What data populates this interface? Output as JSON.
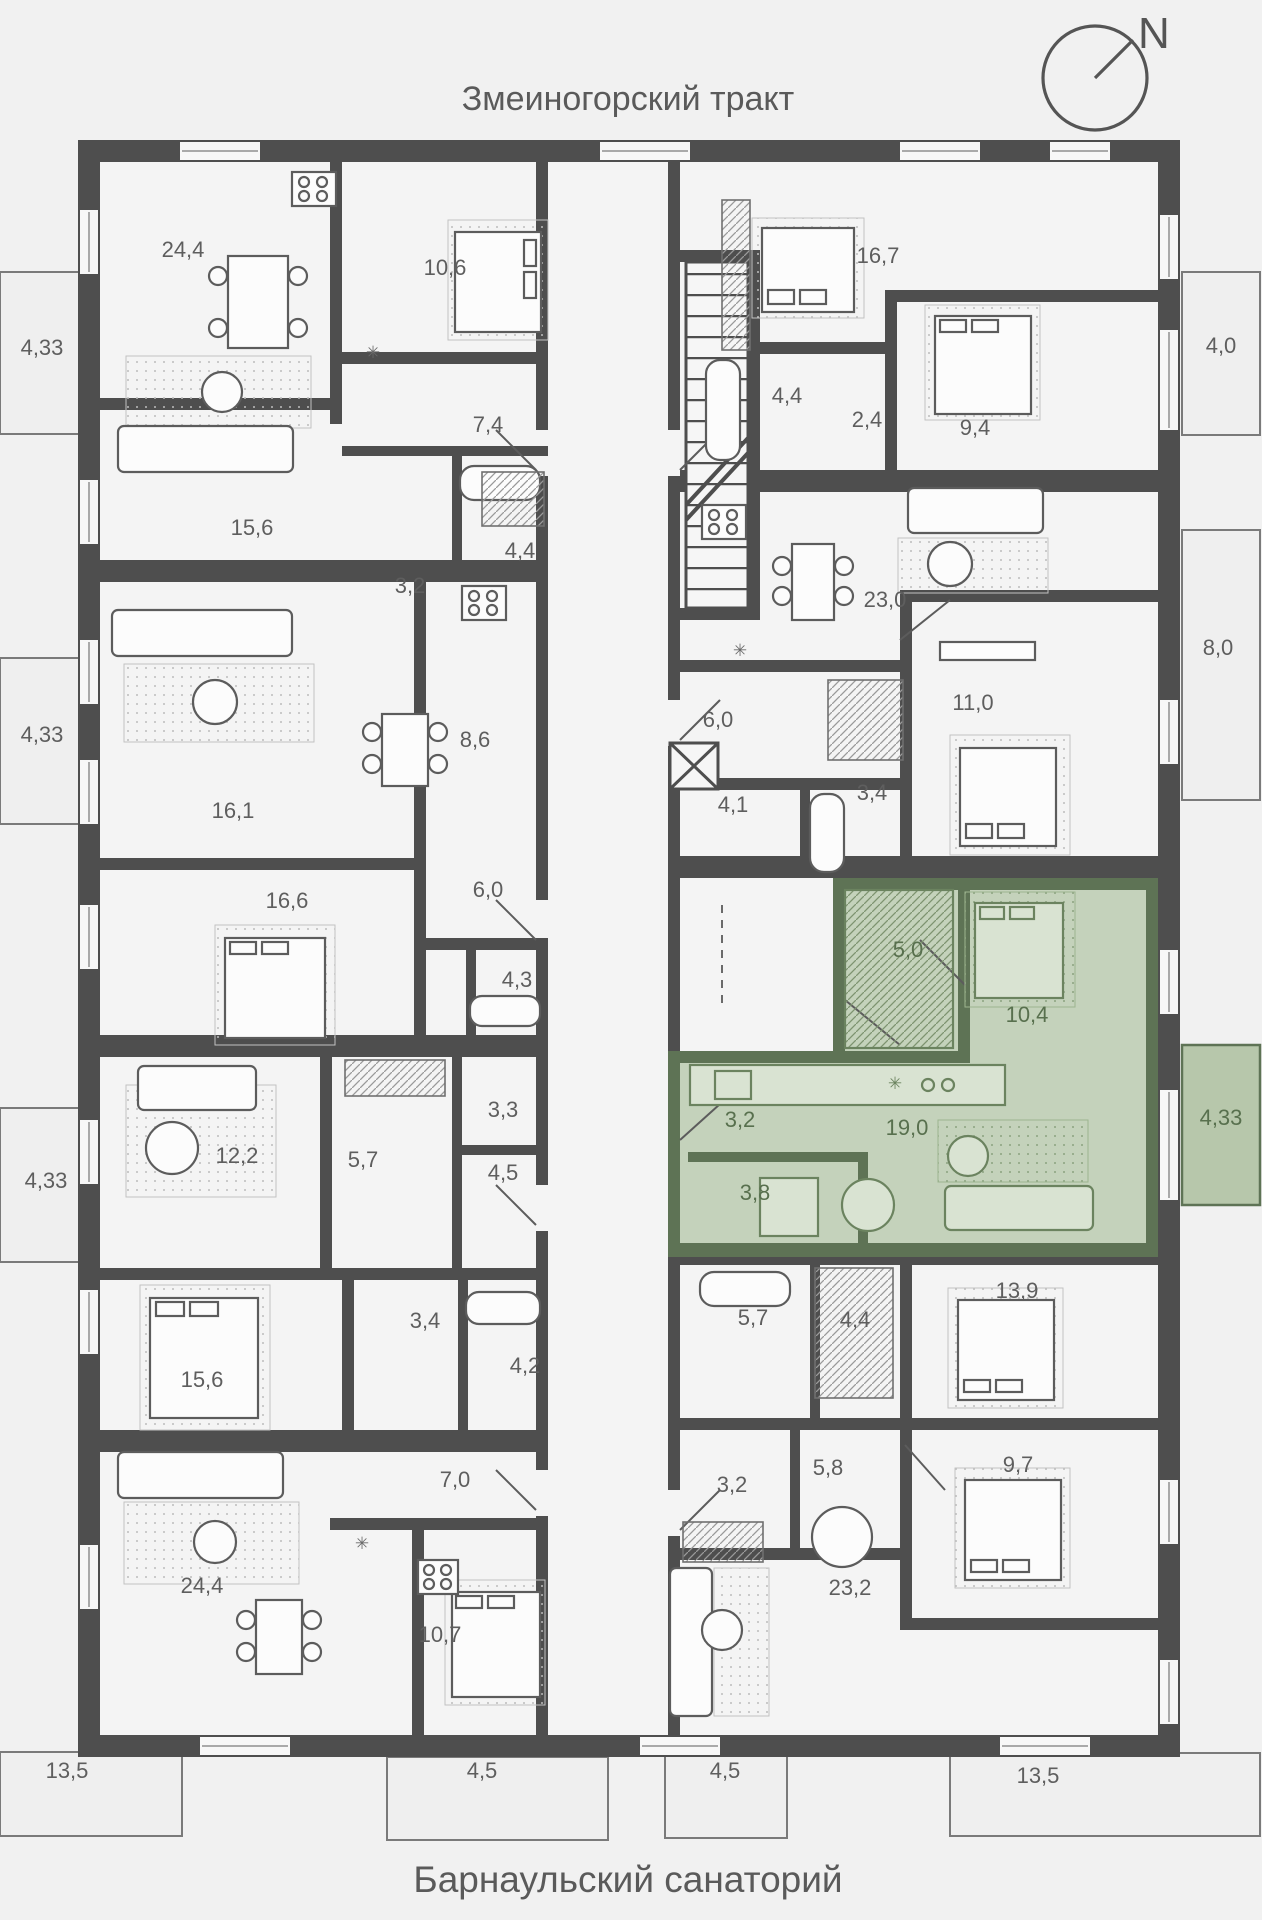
{
  "titles": {
    "top": "Змеиногорский тракт",
    "bottom": "Барнаульский санаторий"
  },
  "compass": {
    "label": "N"
  },
  "colors": {
    "background": "#f1f1f1",
    "room_fill": "#f4f4f4",
    "wall": "#4e4e4e",
    "furniture_stroke": "#5c5c5c",
    "balcony_fill": "#efefef",
    "highlight_room_fill": "#c4d2bb",
    "highlight_wall": "#5e7355",
    "highlight_furniture_stroke": "#6b835f",
    "highlight_balcony_fill": "#b7c7ab",
    "label_text": "#5e5e5e",
    "highlight_label_text": "#58704e"
  },
  "highlighted_apartment": {
    "rooms": [
      "5,0",
      "10,4",
      "3,2",
      "19,0",
      "3,8"
    ],
    "balcony": "4,33"
  },
  "area_labels": [
    {
      "t": "24,4",
      "x": 183,
      "y": 257,
      "tone": "gray"
    },
    {
      "t": "10,6",
      "x": 445,
      "y": 275,
      "tone": "gray"
    },
    {
      "t": "7,4",
      "x": 488,
      "y": 432,
      "tone": "gray"
    },
    {
      "t": "15,6",
      "x": 252,
      "y": 535,
      "tone": "gray"
    },
    {
      "t": "3,2",
      "x": 410,
      "y": 593,
      "tone": "gray"
    },
    {
      "t": "4,4",
      "x": 520,
      "y": 558,
      "tone": "gray"
    },
    {
      "t": "16,1",
      "x": 233,
      "y": 818,
      "tone": "gray"
    },
    {
      "t": "8,6",
      "x": 475,
      "y": 747,
      "tone": "gray"
    },
    {
      "t": "16,6",
      "x": 287,
      "y": 908,
      "tone": "gray"
    },
    {
      "t": "6,0",
      "x": 488,
      "y": 897,
      "tone": "gray"
    },
    {
      "t": "4,3",
      "x": 517,
      "y": 987,
      "tone": "gray"
    },
    {
      "t": "12,2",
      "x": 237,
      "y": 1163,
      "tone": "gray"
    },
    {
      "t": "5,7",
      "x": 363,
      "y": 1167,
      "tone": "gray"
    },
    {
      "t": "3,3",
      "x": 503,
      "y": 1117,
      "tone": "gray"
    },
    {
      "t": "4,5",
      "x": 503,
      "y": 1180,
      "tone": "gray"
    },
    {
      "t": "15,6",
      "x": 202,
      "y": 1387,
      "tone": "gray"
    },
    {
      "t": "3,4",
      "x": 425,
      "y": 1328,
      "tone": "gray"
    },
    {
      "t": "4,2",
      "x": 525,
      "y": 1373,
      "tone": "gray"
    },
    {
      "t": "7,0",
      "x": 455,
      "y": 1487,
      "tone": "gray"
    },
    {
      "t": "24,4",
      "x": 202,
      "y": 1593,
      "tone": "gray"
    },
    {
      "t": "10,7",
      "x": 440,
      "y": 1642,
      "tone": "gray"
    },
    {
      "t": "16,7",
      "x": 878,
      "y": 263,
      "tone": "gray"
    },
    {
      "t": "4,4",
      "x": 787,
      "y": 403,
      "tone": "gray"
    },
    {
      "t": "2,4",
      "x": 867,
      "y": 427,
      "tone": "gray"
    },
    {
      "t": "9,4",
      "x": 975,
      "y": 435,
      "tone": "gray"
    },
    {
      "t": "23,0",
      "x": 885,
      "y": 607,
      "tone": "gray"
    },
    {
      "t": "6,0",
      "x": 718,
      "y": 727,
      "tone": "gray"
    },
    {
      "t": "4,1",
      "x": 733,
      "y": 812,
      "tone": "gray"
    },
    {
      "t": "3,4",
      "x": 872,
      "y": 800,
      "tone": "gray"
    },
    {
      "t": "11,0",
      "x": 973,
      "y": 710,
      "tone": "gray"
    },
    {
      "t": "5,7",
      "x": 753,
      "y": 1325,
      "tone": "gray"
    },
    {
      "t": "4,4",
      "x": 855,
      "y": 1327,
      "tone": "gray"
    },
    {
      "t": "13,9",
      "x": 1017,
      "y": 1298,
      "tone": "gray"
    },
    {
      "t": "3,2",
      "x": 732,
      "y": 1492,
      "tone": "gray"
    },
    {
      "t": "5,8",
      "x": 828,
      "y": 1475,
      "tone": "gray"
    },
    {
      "t": "9,7",
      "x": 1018,
      "y": 1472,
      "tone": "gray"
    },
    {
      "t": "23,2",
      "x": 850,
      "y": 1595,
      "tone": "gray"
    },
    {
      "t": "4,33",
      "x": 42,
      "y": 355,
      "tone": "gray"
    },
    {
      "t": "4,33",
      "x": 42,
      "y": 742,
      "tone": "gray"
    },
    {
      "t": "4,33",
      "x": 46,
      "y": 1188,
      "tone": "gray"
    },
    {
      "t": "13,5",
      "x": 67,
      "y": 1778,
      "tone": "gray"
    },
    {
      "t": "4,5",
      "x": 482,
      "y": 1778,
      "tone": "gray"
    },
    {
      "t": "4,5",
      "x": 725,
      "y": 1778,
      "tone": "gray"
    },
    {
      "t": "13,5",
      "x": 1038,
      "y": 1783,
      "tone": "gray"
    },
    {
      "t": "4,0",
      "x": 1221,
      "y": 353,
      "tone": "gray"
    },
    {
      "t": "8,0",
      "x": 1218,
      "y": 655,
      "tone": "gray"
    },
    {
      "t": "5,0",
      "x": 908,
      "y": 957,
      "tone": "green"
    },
    {
      "t": "10,4",
      "x": 1027,
      "y": 1022,
      "tone": "green"
    },
    {
      "t": "3,2",
      "x": 740,
      "y": 1127,
      "tone": "green"
    },
    {
      "t": "19,0",
      "x": 907,
      "y": 1135,
      "tone": "green"
    },
    {
      "t": "3,8",
      "x": 755,
      "y": 1200,
      "tone": "green"
    },
    {
      "t": "4,33",
      "x": 1221,
      "y": 1125,
      "tone": "green"
    }
  ],
  "kitchen_marks": [
    {
      "x": 373,
      "y": 358,
      "tone": "gray"
    },
    {
      "x": 740,
      "y": 656,
      "tone": "gray"
    },
    {
      "x": 362,
      "y": 1549,
      "tone": "gray"
    },
    {
      "x": 895,
      "y": 1089,
      "tone": "green"
    }
  ]
}
